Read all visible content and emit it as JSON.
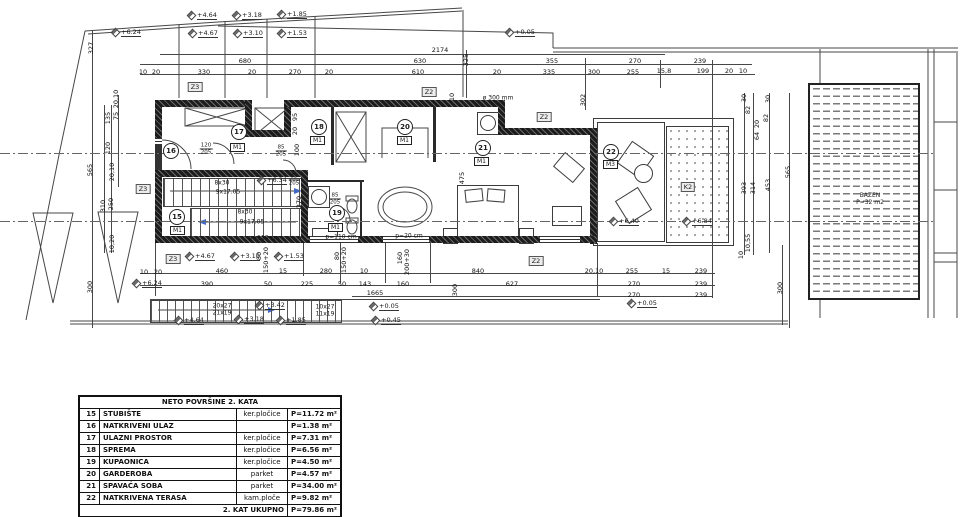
{
  "plan": {
    "pool": {
      "line1": "BAZEN",
      "line2": "P=32 m2"
    },
    "rooms": [
      {
        "num": "15",
        "tag": "M1",
        "x": 176,
        "y": 216,
        "tx": 178,
        "ty": 231
      },
      {
        "num": "16",
        "tag": null,
        "x": 170,
        "y": 150,
        "tx": 0,
        "ty": 0
      },
      {
        "num": "17",
        "tag": "M1",
        "x": 238,
        "y": 131,
        "tx": 238,
        "ty": 148
      },
      {
        "num": "18",
        "tag": "M1",
        "x": 318,
        "y": 126,
        "tx": 318,
        "ty": 141
      },
      {
        "num": "19",
        "tag": "M1",
        "x": 336,
        "y": 212,
        "tx": 336,
        "ty": 228
      },
      {
        "num": "20",
        "tag": "M1",
        "x": 404,
        "y": 126,
        "tx": 405,
        "ty": 141
      },
      {
        "num": "21",
        "tag": "M1",
        "x": 482,
        "y": 147,
        "tx": 482,
        "ty": 162
      },
      {
        "num": "22",
        "tag": "M3",
        "x": 610,
        "y": 151,
        "tx": 611,
        "ty": 165
      }
    ],
    "wall_tags": [
      {
        "t": "Z3",
        "x": 195,
        "y": 87
      },
      {
        "t": "Z2",
        "x": 429,
        "y": 92
      },
      {
        "t": "Z2",
        "x": 544,
        "y": 117
      },
      {
        "t": "Z3",
        "x": 143,
        "y": 189
      },
      {
        "t": "Z3",
        "x": 173,
        "y": 259
      },
      {
        "t": "Z2",
        "x": 536,
        "y": 261
      },
      {
        "t": "K2",
        "x": 688,
        "y": 187
      }
    ],
    "elevations": [
      {
        "t": "+4.64",
        "x": 188,
        "y": 11
      },
      {
        "t": "+3.18",
        "x": 233,
        "y": 11
      },
      {
        "t": "+1.85",
        "x": 278,
        "y": 10
      },
      {
        "t": "+6.24",
        "x": 112,
        "y": 28
      },
      {
        "t": "+4.67",
        "x": 189,
        "y": 29
      },
      {
        "t": "+3.10",
        "x": 234,
        "y": 29
      },
      {
        "t": "+1.53",
        "x": 278,
        "y": 29
      },
      {
        "t": "+0.05",
        "x": 506,
        "y": 28
      },
      {
        "t": "+6.34",
        "x": 258,
        "y": 176
      },
      {
        "t": "+6.40",
        "x": 610,
        "y": 217
      },
      {
        "t": "+6.84",
        "x": 683,
        "y": 217
      },
      {
        "t": "+6.24",
        "x": 133,
        "y": 279
      },
      {
        "t": "+4.67",
        "x": 186,
        "y": 252
      },
      {
        "t": "+3.10",
        "x": 231,
        "y": 252
      },
      {
        "t": "+1.53",
        "x": 275,
        "y": 252
      },
      {
        "t": "+3.42",
        "x": 256,
        "y": 301
      },
      {
        "t": "+4.64",
        "x": 175,
        "y": 316
      },
      {
        "t": "+3.18",
        "x": 235,
        "y": 315
      },
      {
        "t": "+1.85",
        "x": 277,
        "y": 316
      },
      {
        "t": "+0.05",
        "x": 370,
        "y": 302
      },
      {
        "t": "+0.45",
        "x": 372,
        "y": 316
      },
      {
        "t": "+0.05",
        "x": 628,
        "y": 299
      }
    ],
    "dims_h": [
      {
        "t": "2174",
        "x": 440,
        "y": 50
      },
      {
        "t": "680",
        "x": 245,
        "y": 61
      },
      {
        "t": "630",
        "x": 420,
        "y": 61
      },
      {
        "t": "355",
        "x": 552,
        "y": 61
      },
      {
        "t": "270",
        "x": 635,
        "y": 61
      },
      {
        "t": "239",
        "x": 700,
        "y": 61
      },
      {
        "t": "10",
        "x": 143,
        "y": 72
      },
      {
        "t": "20",
        "x": 156,
        "y": 72
      },
      {
        "t": "330",
        "x": 204,
        "y": 72
      },
      {
        "t": "20",
        "x": 252,
        "y": 72
      },
      {
        "t": "270",
        "x": 295,
        "y": 72
      },
      {
        "t": "20",
        "x": 329,
        "y": 72
      },
      {
        "t": "610",
        "x": 418,
        "y": 72
      },
      {
        "t": "20",
        "x": 497,
        "y": 72
      },
      {
        "t": "335",
        "x": 549,
        "y": 72
      },
      {
        "t": "300",
        "x": 594,
        "y": 72
      },
      {
        "t": "255",
        "x": 633,
        "y": 72
      },
      {
        "t": "15,8",
        "x": 664,
        "y": 71
      },
      {
        "t": "199",
        "x": 703,
        "y": 71
      },
      {
        "t": "20",
        "x": 729,
        "y": 71
      },
      {
        "t": "10",
        "x": 743,
        "y": 71
      },
      {
        "t": "10",
        "x": 144,
        "y": 272
      },
      {
        "t": "20",
        "x": 158,
        "y": 272
      },
      {
        "t": "460",
        "x": 222,
        "y": 271
      },
      {
        "t": "15",
        "x": 283,
        "y": 271
      },
      {
        "t": "280",
        "x": 326,
        "y": 271
      },
      {
        "t": "10",
        "x": 364,
        "y": 271
      },
      {
        "t": "840",
        "x": 478,
        "y": 271
      },
      {
        "t": "20,10",
        "x": 594,
        "y": 271
      },
      {
        "t": "255",
        "x": 632,
        "y": 271
      },
      {
        "t": "15",
        "x": 666,
        "y": 271
      },
      {
        "t": "239",
        "x": 701,
        "y": 271
      },
      {
        "t": "390",
        "x": 207,
        "y": 284
      },
      {
        "t": "50",
        "x": 268,
        "y": 284
      },
      {
        "t": "225",
        "x": 307,
        "y": 284
      },
      {
        "t": "50",
        "x": 342,
        "y": 284
      },
      {
        "t": "143",
        "x": 365,
        "y": 284
      },
      {
        "t": "160",
        "x": 403,
        "y": 284
      },
      {
        "t": "627",
        "x": 512,
        "y": 284
      },
      {
        "t": "270",
        "x": 634,
        "y": 284
      },
      {
        "t": "239",
        "x": 701,
        "y": 284
      },
      {
        "t": "1665",
        "x": 375,
        "y": 293
      },
      {
        "t": "270",
        "x": 634,
        "y": 295
      },
      {
        "t": "239",
        "x": 701,
        "y": 295
      }
    ],
    "dims_v": [
      {
        "t": "327",
        "x": 91,
        "y": 48
      },
      {
        "t": "135",
        "x": 108,
        "y": 118
      },
      {
        "t": "75",
        "x": 116,
        "y": 116
      },
      {
        "t": "20,10",
        "x": 116,
        "y": 99
      },
      {
        "t": "120",
        "x": 108,
        "y": 148
      },
      {
        "t": "20,10",
        "x": 112,
        "y": 172
      },
      {
        "t": "565",
        "x": 90,
        "y": 170
      },
      {
        "t": "310",
        "x": 103,
        "y": 206
      },
      {
        "t": "250",
        "x": 111,
        "y": 204
      },
      {
        "t": "10,20",
        "x": 112,
        "y": 244
      },
      {
        "t": "300",
        "x": 90,
        "y": 287
      },
      {
        "t": "325",
        "x": 466,
        "y": 60
      },
      {
        "t": "10",
        "x": 452,
        "y": 97
      },
      {
        "t": "302",
        "x": 583,
        "y": 100
      },
      {
        "t": "95",
        "x": 295,
        "y": 117
      },
      {
        "t": "20",
        "x": 295,
        "y": 131
      },
      {
        "t": "100",
        "x": 297,
        "y": 150
      },
      {
        "t": "270",
        "x": 299,
        "y": 202
      },
      {
        "t": "475",
        "x": 462,
        "y": 178
      },
      {
        "t": "30",
        "x": 744,
        "y": 98
      },
      {
        "t": "82",
        "x": 748,
        "y": 110
      },
      {
        "t": "30",
        "x": 768,
        "y": 99
      },
      {
        "t": "82",
        "x": 766,
        "y": 118
      },
      {
        "t": "20",
        "x": 757,
        "y": 124
      },
      {
        "t": "64",
        "x": 757,
        "y": 136
      },
      {
        "t": "393",
        "x": 744,
        "y": 188
      },
      {
        "t": "314",
        "x": 753,
        "y": 188
      },
      {
        "t": "453",
        "x": 768,
        "y": 185
      },
      {
        "t": "565",
        "x": 788,
        "y": 172
      },
      {
        "t": "10,55",
        "x": 748,
        "y": 243
      },
      {
        "t": "10",
        "x": 741,
        "y": 255
      },
      {
        "t": "300",
        "x": 455,
        "y": 290
      },
      {
        "t": "300",
        "x": 780,
        "y": 288
      },
      {
        "t": "80",
        "x": 259,
        "y": 256
      },
      {
        "t": "150+20",
        "x": 266,
        "y": 260
      },
      {
        "t": "80",
        "x": 337,
        "y": 256
      },
      {
        "t": "150+20",
        "x": 344,
        "y": 260
      },
      {
        "t": "160",
        "x": 400,
        "y": 258
      },
      {
        "t": "200+30",
        "x": 407,
        "y": 262
      }
    ],
    "door_labels": [
      {
        "a": "120",
        "b": "205",
        "x": 206,
        "y": 149
      },
      {
        "a": "85",
        "b": "205",
        "x": 281,
        "y": 151
      },
      {
        "a": "85",
        "b": "205",
        "x": 294,
        "y": 180
      },
      {
        "a": "85",
        "b": "205",
        "x": 335,
        "y": 199
      }
    ],
    "notes": [
      {
        "t": "ø 300 mm",
        "x": 498,
        "y": 98
      },
      {
        "t": "8x30",
        "x": 222,
        "y": 183
      },
      {
        "t": "9x17.05",
        "x": 228,
        "y": 192
      },
      {
        "t": "8x30",
        "x": 245,
        "y": 212
      },
      {
        "t": "9x17.05",
        "x": 252,
        "y": 222
      },
      {
        "t": "p=110 cm",
        "x": 264,
        "y": 238
      },
      {
        "t": "p=110 cm",
        "x": 341,
        "y": 237
      },
      {
        "t": "p=20 cm",
        "x": 409,
        "y": 236
      },
      {
        "t": "20x27",
        "x": 222,
        "y": 306
      },
      {
        "t": "21x19",
        "x": 222,
        "y": 313
      },
      {
        "t": "10x27",
        "x": 325,
        "y": 307
      },
      {
        "t": "11x19",
        "x": 325,
        "y": 314
      }
    ]
  },
  "table": {
    "title": "NETO POVRŠINE 2. KATA",
    "rows": [
      {
        "num": "15",
        "name": "STUBIŠTE",
        "material": "ker.pločice",
        "area": "P=11.72 m²"
      },
      {
        "num": "16",
        "name": "NATKRIVENI ULAZ",
        "material": "",
        "area": "P=1.38 m²"
      },
      {
        "num": "17",
        "name": "ULAZNI PROSTOR",
        "material": "ker.pločice",
        "area": "P=7.31 m²"
      },
      {
        "num": "18",
        "name": "SPREMA",
        "material": "ker.pločice",
        "area": "P=6.56 m²"
      },
      {
        "num": "19",
        "name": "KUPAONICA",
        "material": "ker.pločice",
        "area": "P=4.50 m²"
      },
      {
        "num": "20",
        "name": "GARDEROBA",
        "material": "parket",
        "area": "P=4.57 m²"
      },
      {
        "num": "21",
        "name": "SPAVAĆA SOBA",
        "material": "parket",
        "area": "P=34.00 m²"
      },
      {
        "num": "22",
        "name": "NATKRIVENA TERASA",
        "material": "kam.ploče",
        "area": "P=9.82 m²"
      }
    ],
    "total_label": "2. KAT UKUPNO",
    "total_area": "P=79.86 m²"
  }
}
